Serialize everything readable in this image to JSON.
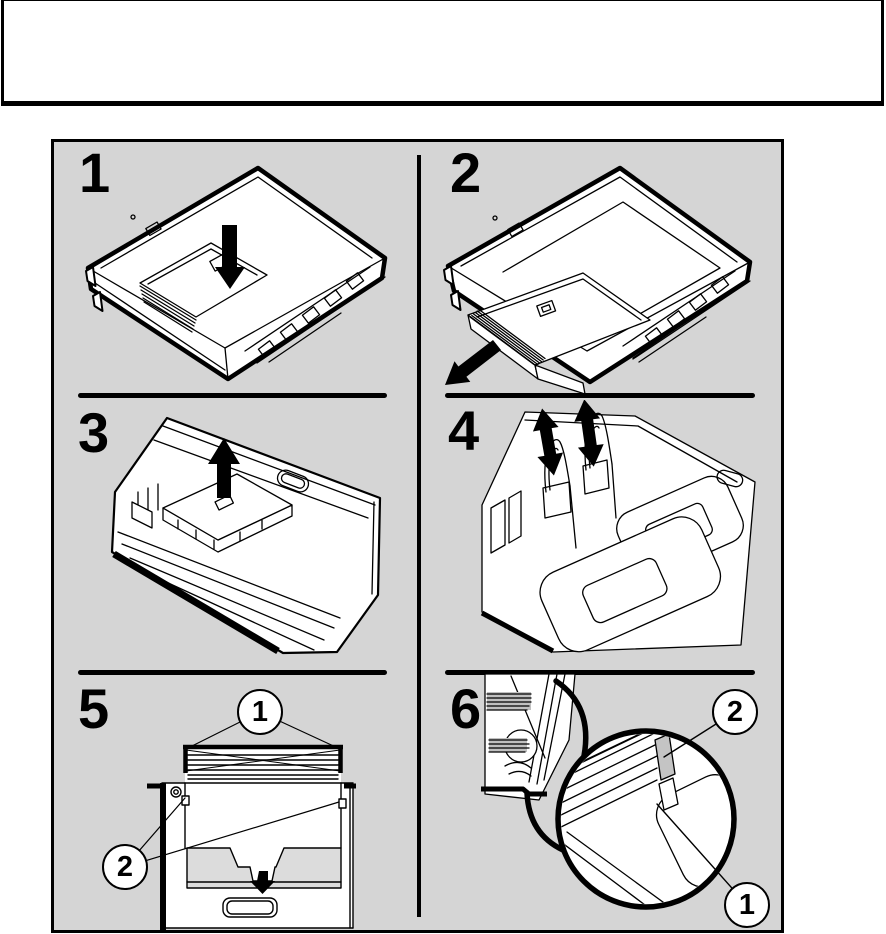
{
  "colors": {
    "page_bg": "#ffffff",
    "panel_bg": "#d5d5d5",
    "line": "#000000",
    "shade_plate": "#dcdcdc",
    "shade_part": "#c4c4c4"
  },
  "header_box": {
    "content": ""
  },
  "figure": {
    "steps": [
      {
        "number": "1",
        "icon": "arrow-down-icon"
      },
      {
        "number": "2",
        "icon": "arrow-down-left-icon"
      },
      {
        "number": "3",
        "icon": "arrow-up-icon"
      },
      {
        "number": "4",
        "icon": "arrows-up-down-icon"
      },
      {
        "number": "5",
        "icon": "arrow-down-icon"
      },
      {
        "number": "6",
        "icon": "magnifier-detail-icon"
      }
    ],
    "step5_callouts": [
      {
        "label": "1"
      },
      {
        "label": "2"
      }
    ],
    "step6_callouts": [
      {
        "label": "2"
      },
      {
        "label": "1"
      }
    ]
  }
}
